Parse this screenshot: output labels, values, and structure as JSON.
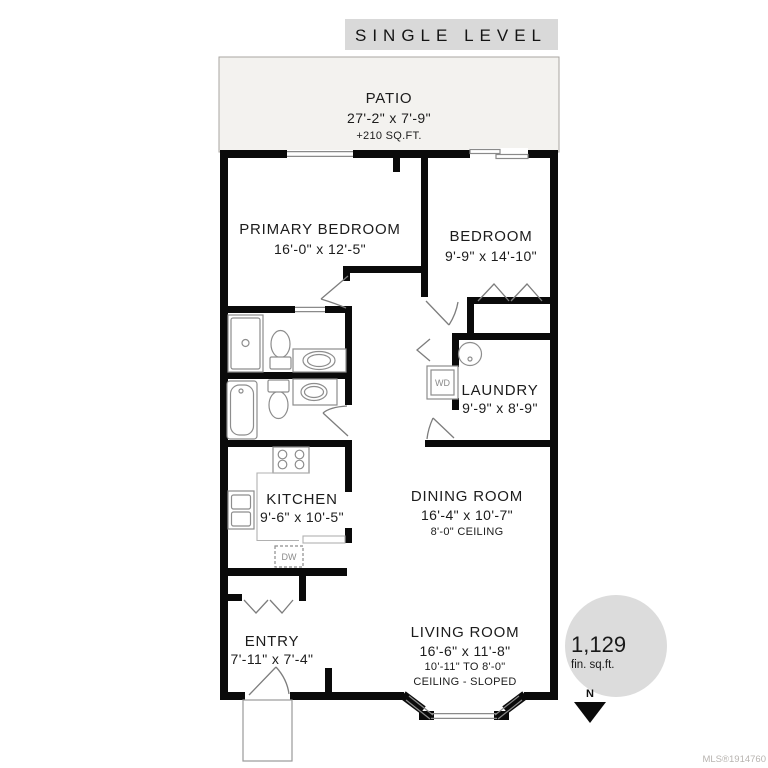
{
  "banner": {
    "title": "SINGLE LEVEL"
  },
  "patio": {
    "name": "PATIO",
    "dims": "27'-2\" x 7'-9\"",
    "area": "+210 SQ.FT."
  },
  "rooms": {
    "primary_bedroom": {
      "name": "PRIMARY BEDROOM",
      "dims": "16'-0\" x 12'-5\""
    },
    "bedroom": {
      "name": "BEDROOM",
      "dims": "9'-9\" x 14'-10\""
    },
    "laundry": {
      "name": "LAUNDRY",
      "dims": "9'-9\" x 8'-9\""
    },
    "kitchen": {
      "name": "KITCHEN",
      "dims": "9'-6\" x 10'-5\""
    },
    "dining_room": {
      "name": "DINING ROOM",
      "dims": "16'-4\" x 10'-7\"",
      "ceiling": "8'-0\" CEILING"
    },
    "living_room": {
      "name": "LIVING ROOM",
      "dims": "16'-6\" x 11'-8\"",
      "ceiling_range": "10'-11\" TO 8'-0\"",
      "ceiling_note": "CEILING - SLOPED"
    },
    "entry": {
      "name": "ENTRY",
      "dims": "7'-11\" x 7'-4\""
    }
  },
  "fixtures": {
    "washer_dryer": "WD",
    "dishwasher": "DW"
  },
  "area_badge": {
    "value": "1,129",
    "unit": "fin. sq.ft."
  },
  "compass": {
    "label": "N"
  },
  "watermark": "MLS®1914760",
  "colors": {
    "wall": "#0a0a0a",
    "banner_bg": "#d9d9d9",
    "badge_bg": "#dcdcdc",
    "patio_bg": "#f3f2ef"
  }
}
